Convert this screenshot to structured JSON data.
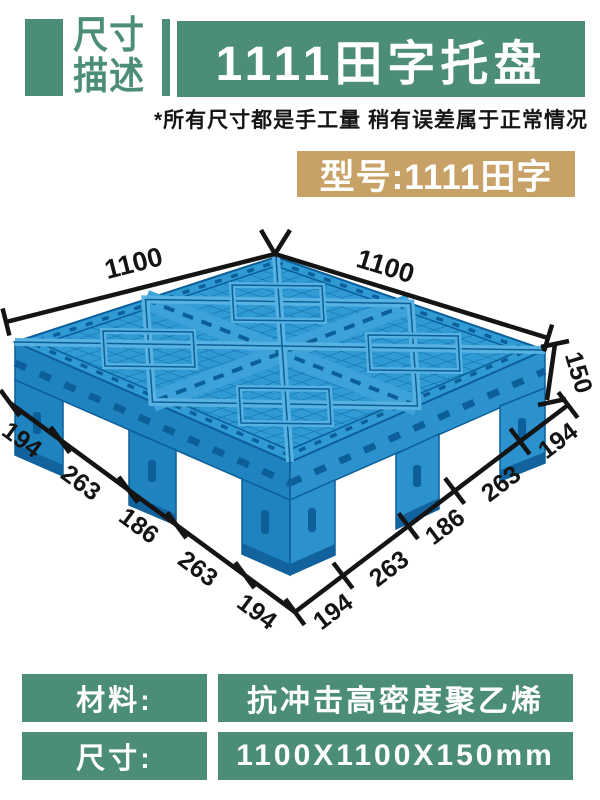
{
  "header": {
    "tag_line1": "尺寸",
    "tag_line2": "描述",
    "banner_title": "1111田字托盘",
    "disclaimer": "*所有尺寸都是手工量 稍有误差属于正常情况"
  },
  "model_badge": {
    "label": "型号:1111田字"
  },
  "colors": {
    "accent_green": "#4b8d75",
    "badge_tan": "#c7a166",
    "pallet_blue_light": "#2f9ad3",
    "pallet_blue_mid": "#1f83c0",
    "pallet_blue_dark": "#0c5f98",
    "dimension_black": "#141414"
  },
  "diagram": {
    "top_left_edge": "1100",
    "top_right_edge": "1100",
    "height_label": "150",
    "left_edge_segments": [
      "194",
      "263",
      "186",
      "263",
      "194"
    ],
    "right_edge_segments": [
      "194",
      "263",
      "186",
      "263",
      "194"
    ]
  },
  "spec_table": {
    "rows": [
      {
        "label": "材料:",
        "value": "抗冲击高密度聚乙烯"
      },
      {
        "label": "尺寸:",
        "value": "1100X1100X150mm"
      }
    ]
  }
}
